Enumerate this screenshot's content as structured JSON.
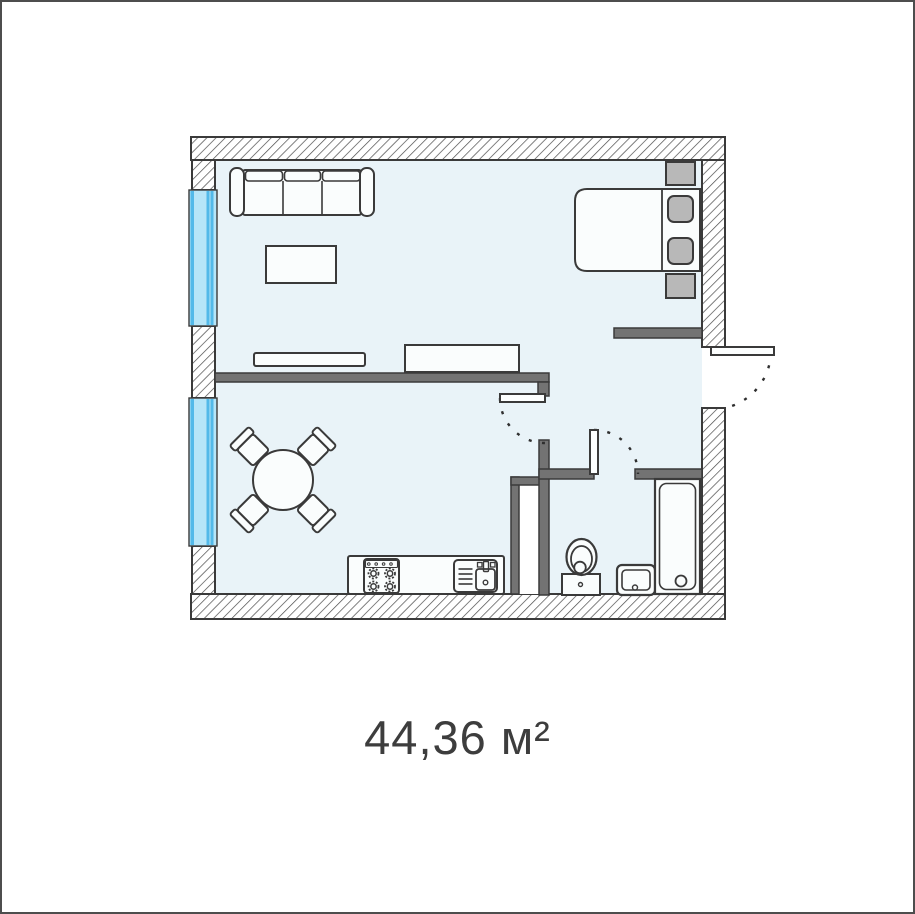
{
  "area_label": "44,36 м²",
  "floor_plan": {
    "type": "apartment-floor-plan",
    "total_area": "44,36",
    "area_unit": "м²",
    "colors": {
      "floor": "#e9f3f8",
      "wall_hatch_line": "#4a4a4a",
      "wall_outline": "#3a3a3a",
      "interior_wall": "#737373",
      "window_glass": "#b6e5f8",
      "window_frame": "#52b9e9",
      "furniture_fill": "#fafdfd",
      "furniture_accent": "#b8b8b8",
      "label_text": "#3d3d3d"
    },
    "symbols": [
      "sofa",
      "coffee-table",
      "tv-stand",
      "dresser",
      "double-bed",
      "pillow",
      "nightstand",
      "dining-table",
      "chair",
      "kitchen-counter",
      "stove",
      "kitchen-sink",
      "duct-shaft",
      "toilet",
      "wash-basin",
      "bathtub",
      "window",
      "door-leaf",
      "door-swing-arc"
    ]
  }
}
